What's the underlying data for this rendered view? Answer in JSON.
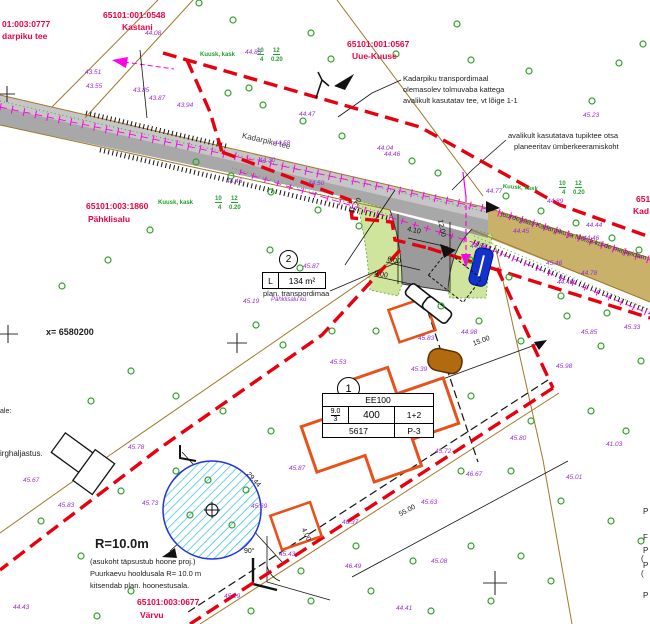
{
  "colors": {
    "boundary_red": "#e8000f",
    "cadastral_red": "#f00040",
    "elevation_purple": "#9b2fd4",
    "tree_green": "#33a02c",
    "utility_magenta": "#ff00e8",
    "road_gray": "#a8a8a8",
    "access_khaki": "#c9b169",
    "landscape_green": "#cfe49c",
    "building_orange": "#e8521a",
    "well_hatch_cyan": "#29bfe0",
    "line_tan": "#a07828"
  },
  "parcel_labels": [
    {
      "t": "01:003:0777",
      "x": 2,
      "y": 20
    },
    {
      "t": "darpiku tee",
      "x": 2,
      "y": 32
    },
    {
      "t": "65101:001:0548",
      "x": 103,
      "y": 11
    },
    {
      "t": "Kastani",
      "x": 122,
      "y": 23
    },
    {
      "t": "65101:001:0567",
      "x": 347,
      "y": 40
    },
    {
      "t": "Uue-Kuuse",
      "x": 352,
      "y": 52
    },
    {
      "t": "65101:003:1860",
      "x": 86,
      "y": 202
    },
    {
      "t": "Pähklisalu",
      "x": 88,
      "y": 215
    },
    {
      "t": "65101:003:0677",
      "x": 137,
      "y": 598
    },
    {
      "t": "Värvu",
      "x": 140,
      "y": 611
    },
    {
      "t": "651",
      "x": 636,
      "y": 195
    },
    {
      "t": "Kad",
      "x": 633,
      "y": 207
    }
  ],
  "annotations": [
    {
      "t": "Kadarpiku transpordimaal",
      "x": 403,
      "y": 75
    },
    {
      "t": "olemasolev tolmuvaba kattega",
      "x": 403,
      "y": 86
    },
    {
      "t": "avalikult kasutatav tee, vt lõige 1-1",
      "x": 403,
      "y": 97
    },
    {
      "t": "avalikult kasutatava tupiktee otsa",
      "x": 508,
      "y": 132
    },
    {
      "t": "planeeritav ümberkeeramiskoht",
      "x": 514,
      "y": 143
    },
    {
      "t": "plan. transpordimaa",
      "x": 263,
      "y": 290
    },
    {
      "t": "x=  6580200",
      "x": 46,
      "y": 328,
      "s": 9,
      "b": 1
    },
    {
      "t": "y=  562400",
      "x": -2,
      "y": 352,
      "r": 90,
      "s": 9,
      "b": 1
    },
    {
      "t": "ale:",
      "x": 0,
      "y": 408,
      "s": 7
    },
    {
      "t": "irghaljastus.",
      "x": 0,
      "y": 450,
      "s": 8
    },
    {
      "t": "R=10.0m",
      "x": 95,
      "y": 537,
      "s": 13,
      "b": 1
    },
    {
      "t": "(asukoht täpsustub hoone proj.)",
      "x": 90,
      "y": 558
    },
    {
      "t": "Puurkaevu hooldusala R= 10.0 m",
      "x": 90,
      "y": 570
    },
    {
      "t": "kitsendab plan. hoonestusala.",
      "x": 90,
      "y": 582
    },
    {
      "t": "Kadarpiku tee",
      "x": 243,
      "y": 132,
      "r": 13,
      "s": 8,
      "c": "roadlbl"
    },
    {
      "t": "juurdepääs Kadarpiku ja Mõisa kü-de majapidam",
      "x": 502,
      "y": 211,
      "r": 17,
      "s": 7,
      "c": "roadlbl"
    },
    {
      "t": "P",
      "x": 643,
      "y": 508,
      "s": 8
    },
    {
      "t": "F",
      "x": 643,
      "y": 534,
      "s": 8
    },
    {
      "t": "P",
      "x": 643,
      "y": 547,
      "s": 8
    },
    {
      "t": "(",
      "x": 641,
      "y": 555,
      "s": 8
    },
    {
      "t": "P",
      "x": 643,
      "y": 562,
      "s": 8
    },
    {
      "t": "(",
      "x": 641,
      "y": 570,
      "s": 8
    },
    {
      "t": "P",
      "x": 643,
      "y": 592,
      "s": 8
    }
  ],
  "dimensions": [
    {
      "t": "11.70",
      "x": 349,
      "y": 212,
      "r": -62
    },
    {
      "t": "4.10",
      "x": 408,
      "y": 226,
      "r": 12
    },
    {
      "t": "12.00",
      "x": 443,
      "y": 219,
      "r": 78
    },
    {
      "t": "6.00",
      "x": 388,
      "y": 256,
      "r": 12
    },
    {
      "t": "9.00",
      "x": 375,
      "y": 270,
      "r": 12
    },
    {
      "t": "15.00",
      "x": 472,
      "y": 341,
      "r": -20
    },
    {
      "t": "29.44",
      "x": 250,
      "y": 471,
      "r": 48
    },
    {
      "t": "55.00",
      "x": 398,
      "y": 512,
      "r": -28
    },
    {
      "t": "4.00",
      "x": 306,
      "y": 527,
      "r": 65
    },
    {
      "t": "90°",
      "x": 244,
      "y": 548
    }
  ],
  "tree_labels": [
    {
      "t": "Kuusk, kask",
      "x": 200,
      "y": 52,
      "c": "grn"
    },
    {
      "t": "10",
      "x": 257,
      "y": 48,
      "c": "fr",
      "s": 6
    },
    {
      "t": "4",
      "x": 260,
      "y": 57,
      "s": 6
    },
    {
      "t": "12",
      "x": 273,
      "y": 48,
      "c": "fr",
      "s": 6
    },
    {
      "t": "0.20",
      "x": 271,
      "y": 57,
      "s": 6
    },
    {
      "t": "Kuusk, kask",
      "x": 158,
      "y": 200,
      "c": "grn"
    },
    {
      "t": "10",
      "x": 215,
      "y": 196,
      "c": "fr",
      "s": 6
    },
    {
      "t": "4",
      "x": 218,
      "y": 205,
      "s": 6
    },
    {
      "t": "12",
      "x": 231,
      "y": 196,
      "c": "fr",
      "s": 6
    },
    {
      "t": "0.20",
      "x": 229,
      "y": 205,
      "s": 6
    },
    {
      "t": "Kuusk, kask",
      "x": 503,
      "y": 184,
      "r": 4,
      "c": "grn"
    },
    {
      "t": "10",
      "x": 559,
      "y": 181,
      "c": "fr",
      "s": 6
    },
    {
      "t": "4",
      "x": 562,
      "y": 190,
      "s": 6
    },
    {
      "t": "12",
      "x": 575,
      "y": 181,
      "c": "fr",
      "s": 6
    },
    {
      "t": "0.20",
      "x": 573,
      "y": 190,
      "s": 6
    }
  ],
  "elevations": [
    {
      "t": "43.51",
      "x": 85,
      "y": 70
    },
    {
      "t": "43.55",
      "x": 86,
      "y": 84
    },
    {
      "t": "43.85",
      "x": 133,
      "y": 88
    },
    {
      "t": "43.87",
      "x": 149,
      "y": 96
    },
    {
      "t": "43.94",
      "x": 177,
      "y": 103
    },
    {
      "t": "44.08",
      "x": 145,
      "y": 31
    },
    {
      "t": "44.85",
      "x": 245,
      "y": 50
    },
    {
      "t": "44.47",
      "x": 299,
      "y": 112
    },
    {
      "t": "44.46",
      "x": 226,
      "y": 179
    },
    {
      "t": "44.50",
      "x": 308,
      "y": 181
    },
    {
      "t": "44.58",
      "x": 274,
      "y": 141
    },
    {
      "t": "44.04",
      "x": 377,
      "y": 146
    },
    {
      "t": "44.30",
      "x": 259,
      "y": 158
    },
    {
      "t": "44.46",
      "x": 384,
      "y": 152
    },
    {
      "t": "44.77",
      "x": 486,
      "y": 189
    },
    {
      "t": "44.89",
      "x": 547,
      "y": 199
    },
    {
      "t": "44.45",
      "x": 513,
      "y": 229
    },
    {
      "t": "44.44",
      "x": 586,
      "y": 223
    },
    {
      "t": "44.46",
      "x": 583,
      "y": 236
    },
    {
      "t": "45.46",
      "x": 546,
      "y": 261
    },
    {
      "t": "44.78",
      "x": 581,
      "y": 271
    },
    {
      "t": "44.48",
      "x": 557,
      "y": 280
    },
    {
      "t": "44.88",
      "x": 470,
      "y": 244
    },
    {
      "t": "45.19",
      "x": 243,
      "y": 299
    },
    {
      "t": "45.87",
      "x": 303,
      "y": 264
    },
    {
      "t": "45.83",
      "x": 418,
      "y": 336
    },
    {
      "t": "45.53",
      "x": 330,
      "y": 360
    },
    {
      "t": "45.39",
      "x": 411,
      "y": 367
    },
    {
      "t": "45.64",
      "x": 396,
      "y": 417
    },
    {
      "t": "45.72",
      "x": 435,
      "y": 449
    },
    {
      "t": "44.98",
      "x": 461,
      "y": 330
    },
    {
      "t": "45.85",
      "x": 581,
      "y": 330
    },
    {
      "t": "45.98",
      "x": 556,
      "y": 364
    },
    {
      "t": "45.80",
      "x": 510,
      "y": 436
    },
    {
      "t": "41.03",
      "x": 606,
      "y": 442
    },
    {
      "t": "46.37",
      "x": 342,
      "y": 520
    },
    {
      "t": "45.43",
      "x": 279,
      "y": 552
    },
    {
      "t": "45.29",
      "x": 224,
      "y": 594
    },
    {
      "t": "46.49",
      "x": 345,
      "y": 564
    },
    {
      "t": "46.67",
      "x": 466,
      "y": 472
    },
    {
      "t": "45.67",
      "x": 23,
      "y": 478
    },
    {
      "t": "45.78",
      "x": 128,
      "y": 445
    },
    {
      "t": "45.83",
      "x": 58,
      "y": 503
    },
    {
      "t": "45.73",
      "x": 142,
      "y": 501
    },
    {
      "t": "45.69",
      "x": 251,
      "y": 504
    },
    {
      "t": "45.01",
      "x": 566,
      "y": 475
    },
    {
      "t": "45.63",
      "x": 421,
      "y": 500
    },
    {
      "t": "45.08",
      "x": 431,
      "y": 559
    },
    {
      "t": "44.41",
      "x": 396,
      "y": 606
    },
    {
      "t": "44.43",
      "x": 13,
      "y": 605
    },
    {
      "t": "45.23",
      "x": 583,
      "y": 113
    },
    {
      "t": "45.33",
      "x": 624,
      "y": 325
    },
    {
      "t": "45.87",
      "x": 289,
      "y": 466
    },
    {
      "t": "Pähklisalu kü",
      "x": 271,
      "y": 297,
      "s": 6
    }
  ],
  "trees": [
    [
      199,
      3
    ],
    [
      233,
      20
    ],
    [
      311,
      33
    ],
    [
      249,
      88
    ],
    [
      331,
      59
    ],
    [
      396,
      54
    ],
    [
      457,
      24
    ],
    [
      471,
      60
    ],
    [
      529,
      71
    ],
    [
      619,
      63
    ],
    [
      592,
      101
    ],
    [
      643,
      44
    ],
    [
      228,
      93
    ],
    [
      263,
      105
    ],
    [
      303,
      121
    ],
    [
      342,
      136
    ],
    [
      412,
      161
    ],
    [
      438,
      173
    ],
    [
      506,
      196
    ],
    [
      541,
      211
    ],
    [
      576,
      223
    ],
    [
      612,
      238
    ],
    [
      639,
      250
    ],
    [
      196,
      162
    ],
    [
      231,
      176
    ],
    [
      271,
      192
    ],
    [
      318,
      210
    ],
    [
      359,
      226
    ],
    [
      470,
      260
    ],
    [
      509,
      277
    ],
    [
      561,
      296
    ],
    [
      607,
      313
    ],
    [
      150,
      230
    ],
    [
      108,
      260
    ],
    [
      62,
      286
    ],
    [
      270,
      250
    ],
    [
      300,
      268
    ],
    [
      256,
      325
    ],
    [
      283,
      345
    ],
    [
      332,
      331
    ],
    [
      376,
      331
    ],
    [
      441,
      306
    ],
    [
      479,
      321
    ],
    [
      521,
      341
    ],
    [
      601,
      346
    ],
    [
      567,
      316
    ],
    [
      641,
      361
    ],
    [
      131,
      371
    ],
    [
      91,
      401
    ],
    [
      176,
      396
    ],
    [
      223,
      411
    ],
    [
      271,
      431
    ],
    [
      471,
      396
    ],
    [
      531,
      421
    ],
    [
      591,
      411
    ],
    [
      626,
      431
    ],
    [
      461,
      471
    ],
    [
      511,
      471
    ],
    [
      561,
      501
    ],
    [
      611,
      521
    ],
    [
      641,
      541
    ],
    [
      176,
      471
    ],
    [
      121,
      491
    ],
    [
      41,
      521
    ],
    [
      81,
      556
    ],
    [
      131,
      591
    ],
    [
      97,
      616
    ],
    [
      251,
      611
    ],
    [
      311,
      601
    ],
    [
      371,
      591
    ],
    [
      431,
      611
    ],
    [
      491,
      601
    ],
    [
      551,
      581
    ],
    [
      301,
      571
    ],
    [
      356,
      546
    ],
    [
      413,
      561
    ],
    [
      471,
      546
    ],
    [
      521,
      556
    ],
    [
      208,
      480
    ],
    [
      246,
      490
    ],
    [
      190,
      515
    ],
    [
      232,
      525
    ]
  ],
  "spec_table": {
    "badge": "1",
    "row1": "EE100",
    "height": "9.0",
    "storeys": "3",
    "area": "400",
    "units": "1+2",
    "plot": "5617",
    "pos": "P-3"
  },
  "area_box": {
    "badge": "2",
    "label": "L",
    "value": "134 m²"
  }
}
